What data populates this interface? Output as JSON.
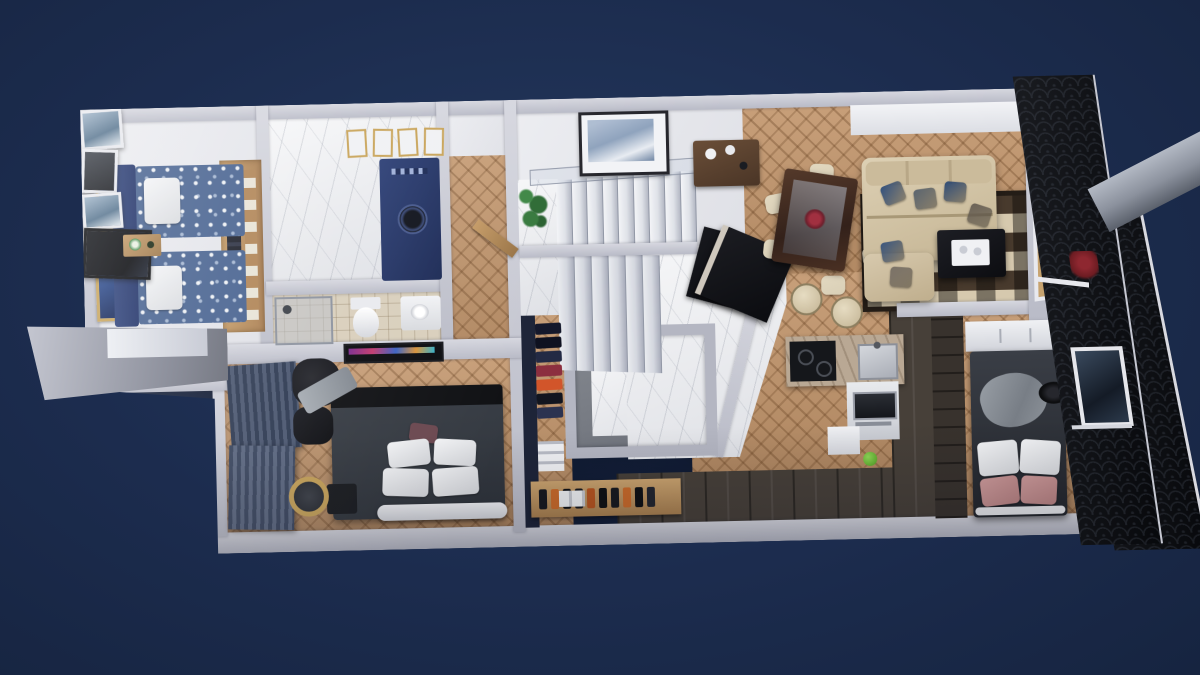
{
  "scene": {
    "description": "Photoreal 3D top-down render of a single-storey apartment floor plan on a navy backdrop",
    "view": "axonometric top-down, slight clockwise scene tilt"
  },
  "palette": {
    "bg-center": "#24395f",
    "bg-mid": "#1c2c4e",
    "bg-edge": "#162440",
    "wall": "#b9bbc7",
    "wall-light": "#d6d7df",
    "floor-white": "#dfe0e6",
    "marble": "#edeef1",
    "wood": "#c1946a",
    "wood-dark": "#a87c52",
    "plank": "#474039",
    "plank-dark": "#38322d",
    "facade": "#0b0d12",
    "navy-bed": "#46618f",
    "navy-wall": "#1d2438",
    "cream": "#cfc1a2",
    "rug-dark": "#483a2d",
    "rug-cream": "#d6c9ae",
    "bed-dark": "#2f343b",
    "curtain": "#33405a",
    "tile": "#d9cfbc",
    "gold": "#c8a358",
    "green": "#3f8746",
    "pink": "#b98383",
    "black": "#101114",
    "counter": "#b9a894"
  },
  "rooms": {
    "twin": {
      "label": "Twin guest bedroom with two blue floral beds and two Starry-Night style framed paintings"
    },
    "utility": {
      "label": "Laundry room with navy washer cabinet and marble floor"
    },
    "bath": {
      "label": "Bathroom with shower, toilet and washbasin"
    },
    "master": {
      "label": "Master bedroom with dark double bed, armchair and pleated curtains"
    },
    "hall": {
      "label": "Hallway with herringbone parquet and open wooden door"
    },
    "stairs": {
      "label": "Central U-shaped marble staircase with glass railing"
    },
    "entry": {
      "label": "Entry hall with marble floor, black mat and console table"
    },
    "closet": {
      "label": "Walk-in closet with garment rack and shoe shelf"
    },
    "shower": {
      "label": "Glazed wet room with marble floor"
    },
    "kitchen": {
      "label": "Kitchen with L-shaped stone counter, cooktop, oven tower and breakfast bar"
    },
    "dining": {
      "label": "Dining area with dark stone table and six cream chairs"
    },
    "living": {
      "label": "Living room with cream sectional sofa, checkered rug, coffee table and gallery wall"
    },
    "bedroom2": {
      "label": "Second bedroom with grey bed, white and rose pillows and dark wardrobe"
    },
    "exterior": {
      "label": "Black shingle street facade with window, red plant, grey chimney duct and skylight"
    }
  },
  "counts": {
    "upper_steps": 9,
    "lower_steps": 6,
    "dining_chairs": 6,
    "small_frames": 4
  },
  "closet": {
    "garments": [
      "#14182b",
      "#0e1120",
      "#232a44",
      "#8c2f3f",
      "#d2552a",
      "#12151f",
      "#2c3350"
    ],
    "shoes": [
      "#17191f",
      "#c96a2a",
      "#0e1014",
      "#17191f",
      "#b55420",
      "#0e1014",
      "#17191f",
      "#c96a2a",
      "#0e1014",
      "#22252e"
    ]
  },
  "living": {
    "gallery_frames": [
      "ocean",
      "dark",
      "ocean",
      "tv"
    ],
    "sofa_pillows": [
      "#31507e",
      "#5a646f",
      "#2f4c77",
      "#6b6257",
      "#3a567f",
      "#7b7268"
    ]
  },
  "dining_chair_color": "#d9cfb6"
}
